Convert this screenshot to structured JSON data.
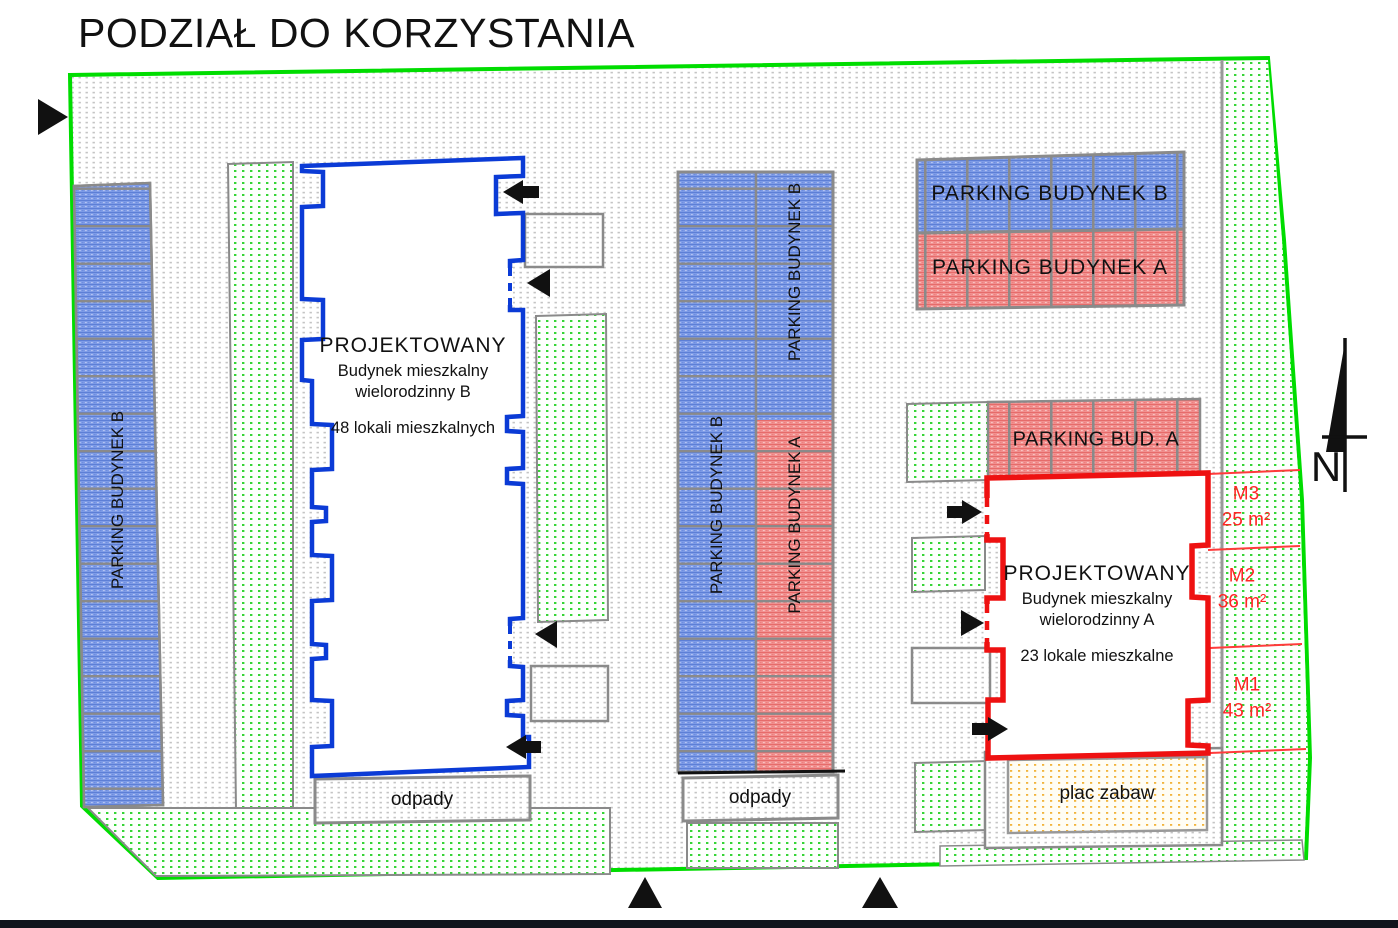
{
  "title": "PODZIAŁ DO KORZYSTANIA",
  "labels": {
    "parking_budynek_b": "PARKING BUDYNEK B",
    "parking_budynek_a": "PARKING BUDYNEK A",
    "parking_bud_a": "PARKING BUD. A",
    "odpady": "odpady",
    "plac_zabaw": "plac zabaw",
    "north": "N"
  },
  "building_b": {
    "line1": "PROJEKTOWANY",
    "line2": "Budynek mieszkalny",
    "line3": "wielorodzinny B",
    "line4": "48 lokali mieszkalnych"
  },
  "building_a": {
    "line1": "PROJEKTOWANY",
    "line2": "Budynek mieszkalny",
    "line3": "wielorodzinny A",
    "line4": "23 lokale mieszkalne"
  },
  "units": [
    {
      "name": "M3",
      "area": "25 m²"
    },
    {
      "name": "M2",
      "area": "36 m²"
    },
    {
      "name": "M1",
      "area": "43 m²"
    }
  ],
  "colors": {
    "boundary_green": "#00dd00",
    "building_b_outline": "#0b3bd6",
    "building_a_outline": "#ee1111",
    "parking_blue": "#7e9ce7",
    "parking_red": "#f19190",
    "unit_label_red": "#ff2525",
    "playground_orange": "#f2b43c"
  }
}
